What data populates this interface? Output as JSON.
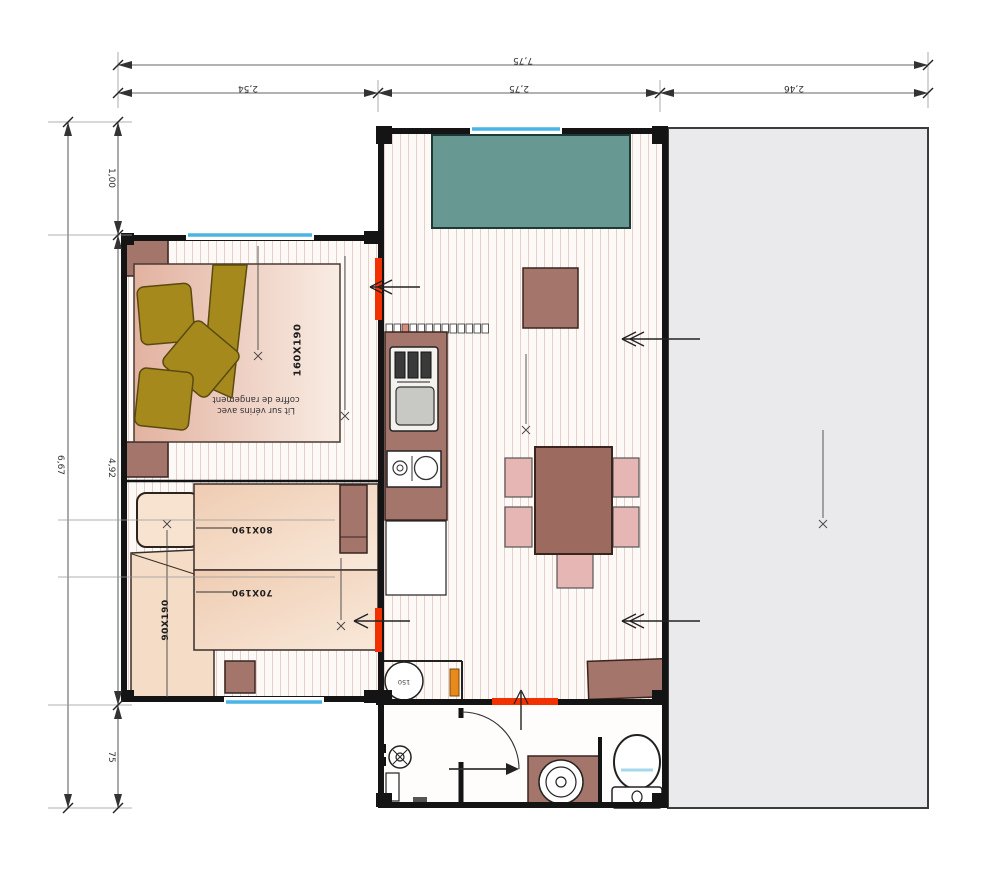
{
  "plan": {
    "dims_top": {
      "total": "7,75",
      "left": "2,54",
      "middle": "2,75",
      "right": "2,46"
    },
    "dims_left": {
      "total": "6,67",
      "top": "1,00",
      "middle": "4,92",
      "bottom": "75"
    },
    "bedroom1": {
      "bed": "160X190",
      "note1": "Lit sur vérins avec",
      "note2": "coffre de rangement"
    },
    "bedroom2": {
      "bed_top": "80X190",
      "bed_middle": "70X190",
      "bed_side": "90X190"
    },
    "utility": {
      "heater": "150"
    },
    "colors": {
      "wall": "#141414",
      "door_red": "#f23000",
      "window_blue": "#49b4e6",
      "sofa_teal": "#679891",
      "wood_brown": "#a4766b",
      "chair_pink": "#e5b6b4",
      "pillow_olive": "#a6891c",
      "bed_peach": "#f4dcc6",
      "terrace_gray": "#eaeaec",
      "door_orange": "#e8891c"
    }
  }
}
